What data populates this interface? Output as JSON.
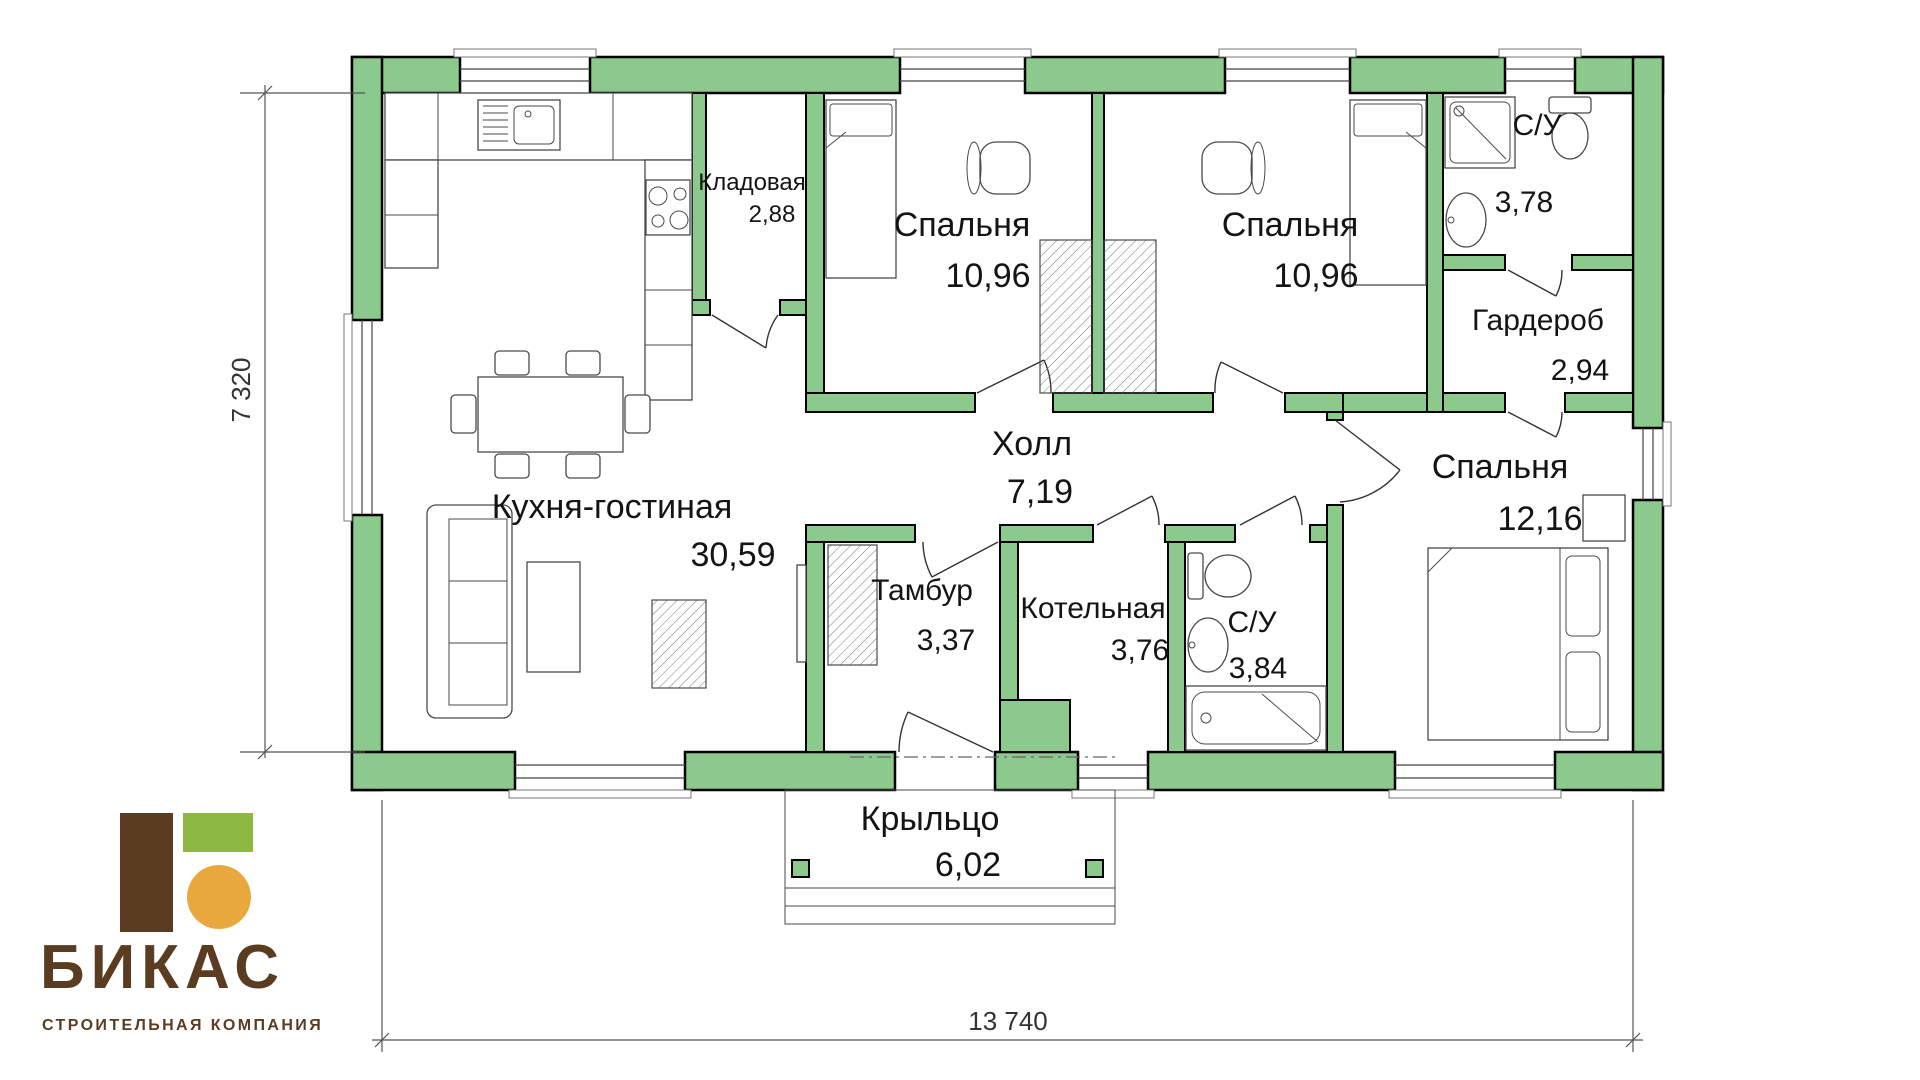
{
  "company": {
    "name": "БИКАС",
    "tagline": "СТРОИТЕЛЬНАЯ КОМПАНИЯ"
  },
  "plan": {
    "overall_width_mm": "13 740",
    "overall_depth_mm": "7 320"
  },
  "rooms": {
    "kitchen_living": {
      "name": "Кухня-гостиная",
      "area": "30,59"
    },
    "pantry": {
      "name": "Кладовая",
      "area": "2,88"
    },
    "bedroom1": {
      "name": "Спальня",
      "area": "10,96"
    },
    "bedroom2": {
      "name": "Спальня",
      "area": "10,96"
    },
    "bathroom1": {
      "name": "С/У",
      "area": "3,78"
    },
    "wardrobe": {
      "name": "Гардероб",
      "area": "2,94"
    },
    "hall": {
      "name": "Холл",
      "area": "7,19"
    },
    "bedroom3": {
      "name": "Спальня",
      "area": "12,16"
    },
    "vestibule": {
      "name": "Тамбур",
      "area": "3,37"
    },
    "boiler_room": {
      "name": "Котельная",
      "area": "3,76"
    },
    "bathroom2": {
      "name": "С/У",
      "area": "3,84"
    },
    "porch": {
      "name": "Крыльцо",
      "area": "6,02"
    }
  },
  "colors": {
    "wall_fill": "#8CC98C",
    "logo_brown": "#5A3C21",
    "logo_green": "#8DB843",
    "logo_orange": "#E9A83E"
  }
}
